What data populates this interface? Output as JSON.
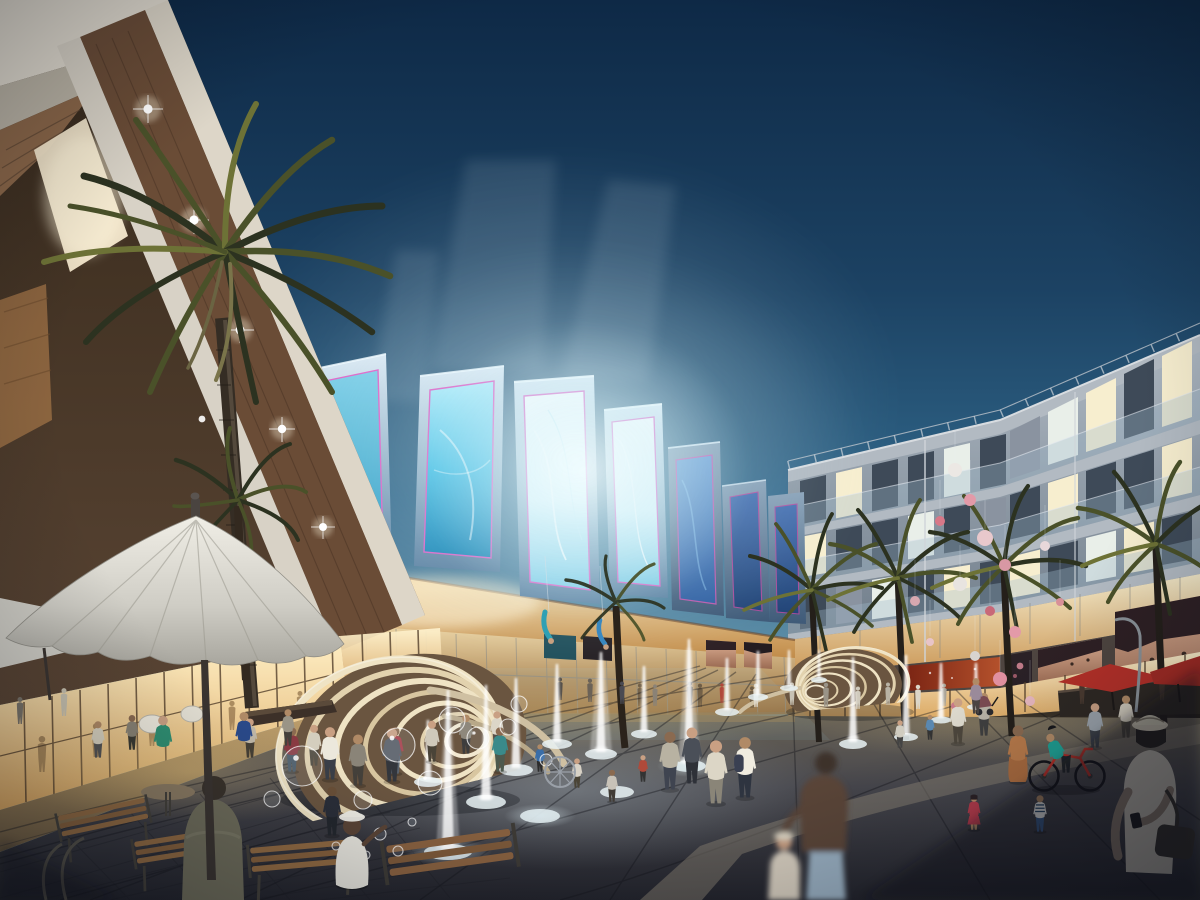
{
  "scene": {
    "description": "Dusk photorealistic architectural rendering of a shopping plaza: tilted LED billboard marquee over a glowing mall entrance, residential balcony block at right, palm trees, ribbed shell sculptures, pop-jet fountains with soap bubbles, outdoor cafe with white umbrella, and strolling crowds",
    "time_of_day": "dusk",
    "medium": "CGI render",
    "text_on_screen": "none"
  },
  "palette": {
    "sky_top": "#0e2946",
    "sky_mid": "#1c4263",
    "sky_low": "#2f6487",
    "sky_haze": "#6d9cb2",
    "sky_horizon": "#accfd8",
    "glow_core": "#f4feff",
    "screen_frame_light": "#dceaf4",
    "screen_frame": "#9db8cc",
    "screen_frame_deep": "#5d82a2",
    "screen_teal": "#2f9fc6",
    "screen_cyan": "#49c2e6",
    "screen_bright": "#e9fbff",
    "screen_blue": "#2d5fa6",
    "screen_deep": "#1c4076",
    "screen_trim_pink": "#e066c8",
    "entrance_warm": "#e3b268",
    "interior_glow": "#ffe9b8",
    "left_wall": "#42321f",
    "left_wood": "#8a6648",
    "left_fascia": "#ddd6c8",
    "right_facade_top": "#b0bac4",
    "right_facade_bottom": "#5a6876",
    "slab": "#b2bac2",
    "window_lit": "#f7eecf",
    "window_cool": "#e9efe9",
    "window_dark": "#3e4a58",
    "window_dim": "#8a93a0",
    "balcony_glass": "#a0b9cb",
    "podium_fascia": "#4e4540",
    "shop_glow_top": "#fff3cf",
    "shop_glow_bottom": "#d39a52",
    "mullion": "#54402c",
    "billboard_red": "#b4512c",
    "skin_light": "#e0b296",
    "skin_deep": "#9a6a52",
    "hair_dark": "#2e2024",
    "umbrella_white": "#dcdad2",
    "umbrella_red": "#b53028",
    "palm_dark": "#2c3220",
    "palm_mid": "#4a5129",
    "palm_light": "#6d7236",
    "trunk": "#3a322a",
    "pavement_light": "#6a6356",
    "pavement_mid": "#46464c",
    "pavement_dark": "#23242c",
    "walkway": "#c2a26e",
    "shell_light": "#f0e7d2",
    "shell_shade": "#6a5540",
    "water": "#ffffff",
    "balloon_pink": "#e39aa8",
    "balloon_white": "#ece8e4",
    "shadow": "#0b0d12"
  }
}
